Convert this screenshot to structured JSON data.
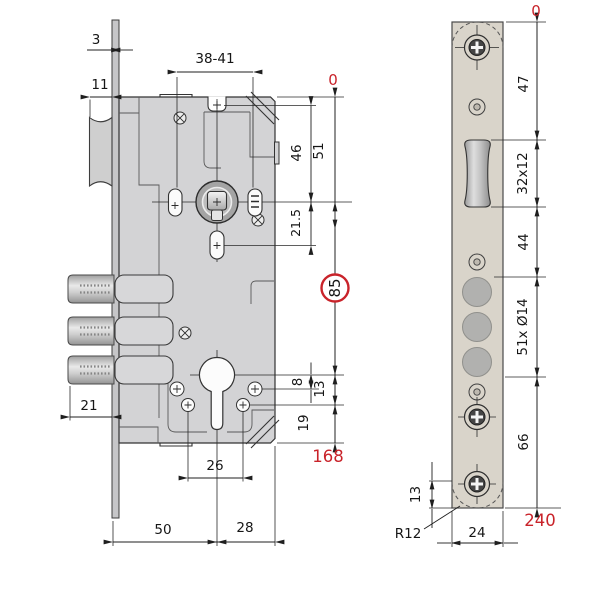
{
  "palette": {
    "accent_red": "#c9232a",
    "case_gray": "#d3d3d5",
    "faceplate_beige": "#d9d4ca"
  },
  "side_view": {
    "labels": {
      "plate_thickness": "3",
      "latch_protrusion": "11",
      "handle_screw_span": "38-41",
      "ref_zero": "0",
      "hole_to_spindle": "46",
      "top_to_spindle": "51",
      "spindle_to_hole": "21.5",
      "centre_distance": "85",
      "cyl_to_hole1": "8",
      "cyl_to_hole2": "13",
      "hole2_to_bottom": "19",
      "overall_height": "168",
      "bolt_throw": "21",
      "cyl_screw_span": "26",
      "backset": "50",
      "case_depth": "28"
    }
  },
  "front_view": {
    "labels": {
      "ref_zero": "0",
      "top_to_latch": "47",
      "latch_cutout": "32x12",
      "latch_to_bolts": "44",
      "bolt_holes": "51x Ø14",
      "bolts_to_end": "66",
      "screw_to_end": "13",
      "end_radius": "R12",
      "plate_width": "24",
      "plate_length": "240"
    }
  }
}
